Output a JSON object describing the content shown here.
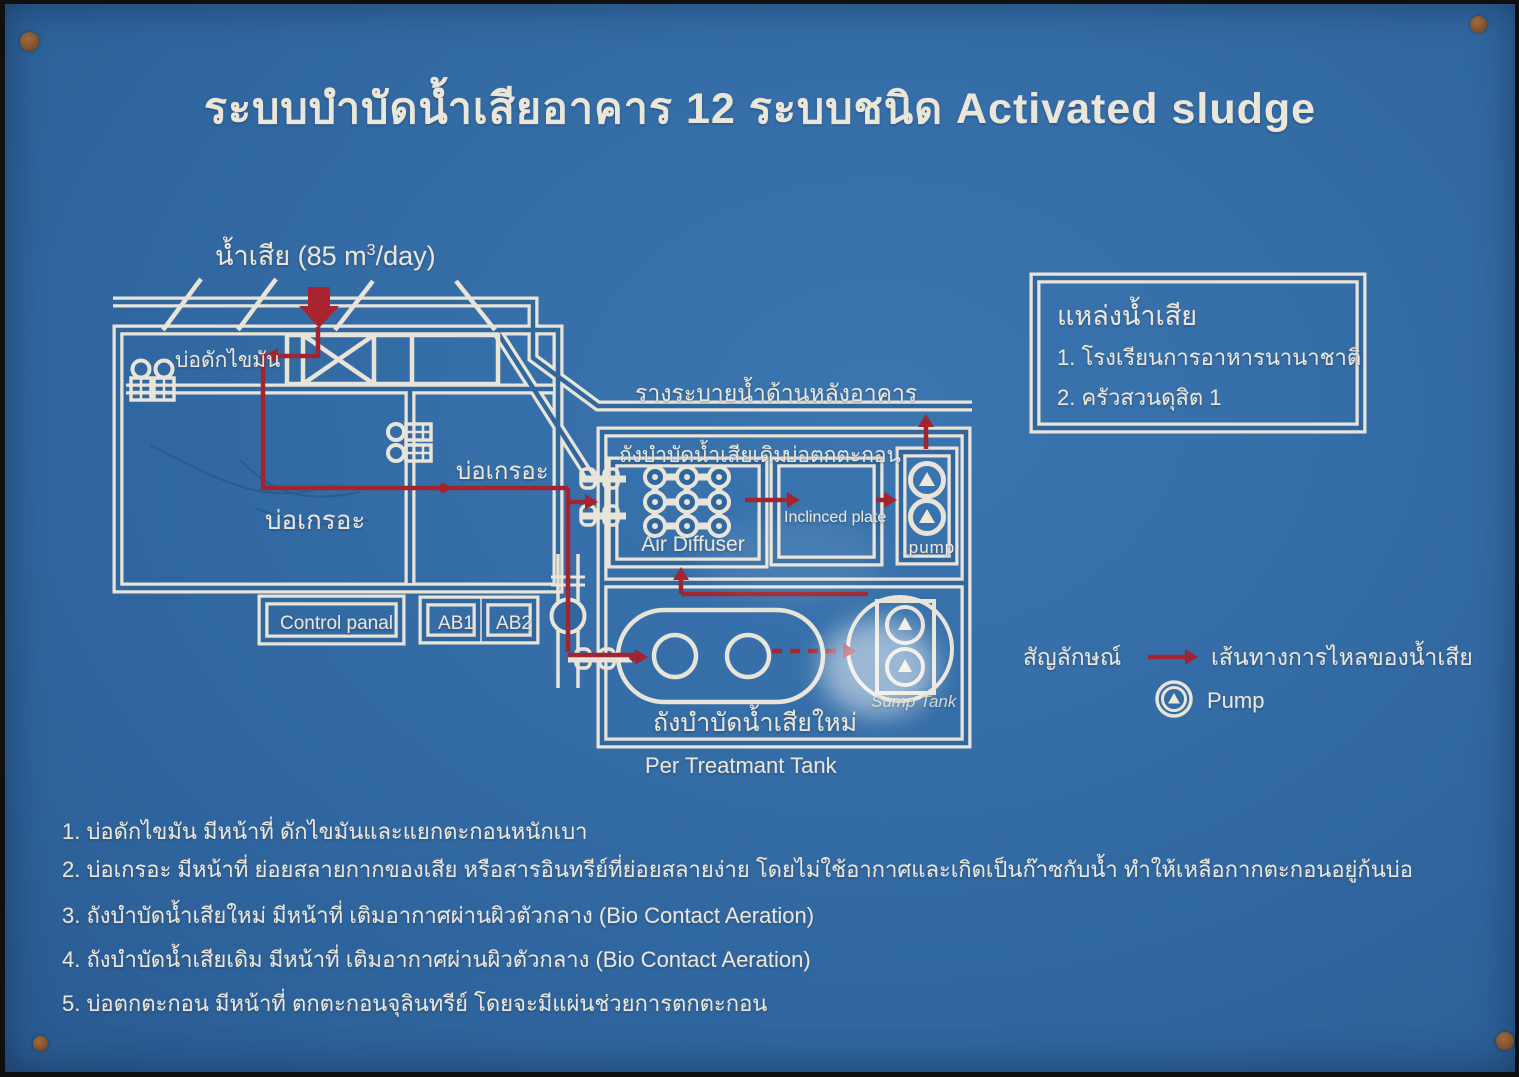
{
  "title": "ระบบบำบัดน้ำเสียอาคาร 12 ระบบชนิด Activated sludge",
  "influent": {
    "prefix": "น้ำเสีย (85 m",
    "sup": "3",
    "suffix": "/day)"
  },
  "labels": {
    "grease_trap": "บ่อดักไขมัน",
    "septic_tank_left": "บ่อเกรอะ",
    "septic_tank_right": "บ่อเกรอะ",
    "control_panel": "Control panal",
    "ab1": "AB1",
    "ab2": "AB2",
    "drain_channel": "รางระบายน้ำด้านหลังอาคาร",
    "old_treatment_tank": "ถังบำบัดน้ำเสียเดิม",
    "sediment_tank": "บ่อตกตะกอน",
    "air_diffuser": "Air Diffuser",
    "inclined_plate": "Inclinced plate",
    "pump_box": "pump",
    "new_treatment_tank": "ถังบำบัดน้ำเสียใหม่",
    "sump_tank": "Sump Tank",
    "pre_treatment_tank": "Per Treatmant Tank"
  },
  "source_box": {
    "title": "แหล่งน้ำเสีย",
    "item1": "1. โรงเรียนการอาหารนานาชาติ",
    "item2": "2. ครัวสวนดุสิต 1"
  },
  "legend": {
    "symbol": "สัญลักษณ์",
    "flow_line": "เส้นทางการไหลของน้ำเสีย",
    "pump": "Pump"
  },
  "notes": [
    "1. บ่อดักไขมัน มีหน้าที่ ดักไขมันและแยกตะกอนหนักเบา",
    "2. บ่อเกรอะ มีหน้าที่ ย่อยสลายกากของเสีย หรือสารอินทรีย์ที่ย่อยสลายง่าย โดยไม่ใช้อากาศและเกิดเป็นก๊าซกับน้ำ ทำให้เหลือกากตะกอนอยู่ก้นบ่อ",
    "3. ถังบำบัดน้ำเสียใหม่ มีหน้าที่ เติมอากาศผ่านผิวตัวกลาง (Bio Contact Aeration)",
    "4. ถังบำบัดน้ำเสียเดิม มีหน้าที่ เติมอากาศผ่านผิวตัวกลาง (Bio Contact Aeration)",
    "5. บ่อตกตะกอน มีหน้าที่ ตกตะกอนจุลินทรีย์ โดยจะมีแผ่นช่วยการตกตะกอน"
  ],
  "colors": {
    "board": "#30679f",
    "line": "#eae6da",
    "flow": "#9e2530",
    "screw": "#8a5a33"
  }
}
